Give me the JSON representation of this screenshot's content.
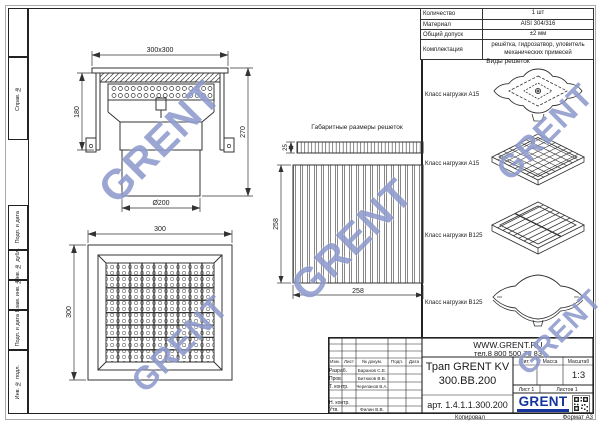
{
  "watermark": {
    "text": "GRENT",
    "color": "#4054AA"
  },
  "frame": {
    "sprav_no": "Справ. №",
    "podp_i_data_upper": "Подп. и дата",
    "inv_no_dubl": "Инв. № дубл.",
    "vzam_inv_no": "Взам. инв. №",
    "podp_i_data_lower": "Подп. и дата",
    "inv_no_podl": "Инв. № подл.",
    "kopiroval": "Копировал",
    "format": "Формат А3"
  },
  "spec_table": {
    "rows": [
      {
        "label": "Количество",
        "value": "1 шт"
      },
      {
        "label": "Материал",
        "value": "AISI 304/316"
      },
      {
        "label": "Общий допуск",
        "value": "±2 мм"
      },
      {
        "label": "Комплектация",
        "value": "решётка, гидрозатвор, уловитель механических примесей"
      }
    ]
  },
  "grates": {
    "section_title": "Виды решеток",
    "items": [
      {
        "label": "Класс нагрузки А15"
      },
      {
        "label": "Класс нагрузки А15"
      },
      {
        "label": "Класс нагрузки В125"
      },
      {
        "label": "Класс нагрузки В125"
      }
    ]
  },
  "views": {
    "section": {
      "dim_top": "300x300",
      "dim_left": "180",
      "dim_right": "270",
      "dim_bottom": "Ø200"
    },
    "plan": {
      "dim_top": "300",
      "dim_left": "300"
    },
    "grate_dim": {
      "title": "Габаритные размеры решеток",
      "thickness": "25",
      "height": "258",
      "width": "258"
    }
  },
  "title_block": {
    "website": "WWW.GRENT.RU",
    "phone": "тел.8 800 500 76 83",
    "header": {
      "izm": "Изм.",
      "list": "Лист",
      "doc": "№ докум.",
      "podp": "Подп.",
      "data": "Дата"
    },
    "signers": [
      {
        "role": "Разраб.",
        "name": "Баранов С.Е."
      },
      {
        "role": "Пров.",
        "name": "Битюков В.В."
      },
      {
        "role": "Т. контр.",
        "name": "Черепанов В.А."
      },
      {
        "role": "Н. контр.",
        "name": ""
      },
      {
        "role": "Утв.",
        "name": "Филин В.В."
      }
    ],
    "product_line1": "Трап GRENT KV",
    "product_line2": "300.BB.200",
    "article": "арт. 1.4.1.1.300.200",
    "lit_label": "Лит.",
    "mass_label": "Масса",
    "scale_label": "Масштаб",
    "scale_value": "1:3",
    "sheet": "Лист 1",
    "sheets": "Листов 1",
    "brand": "GRENT",
    "brand_color": "#16339e"
  }
}
